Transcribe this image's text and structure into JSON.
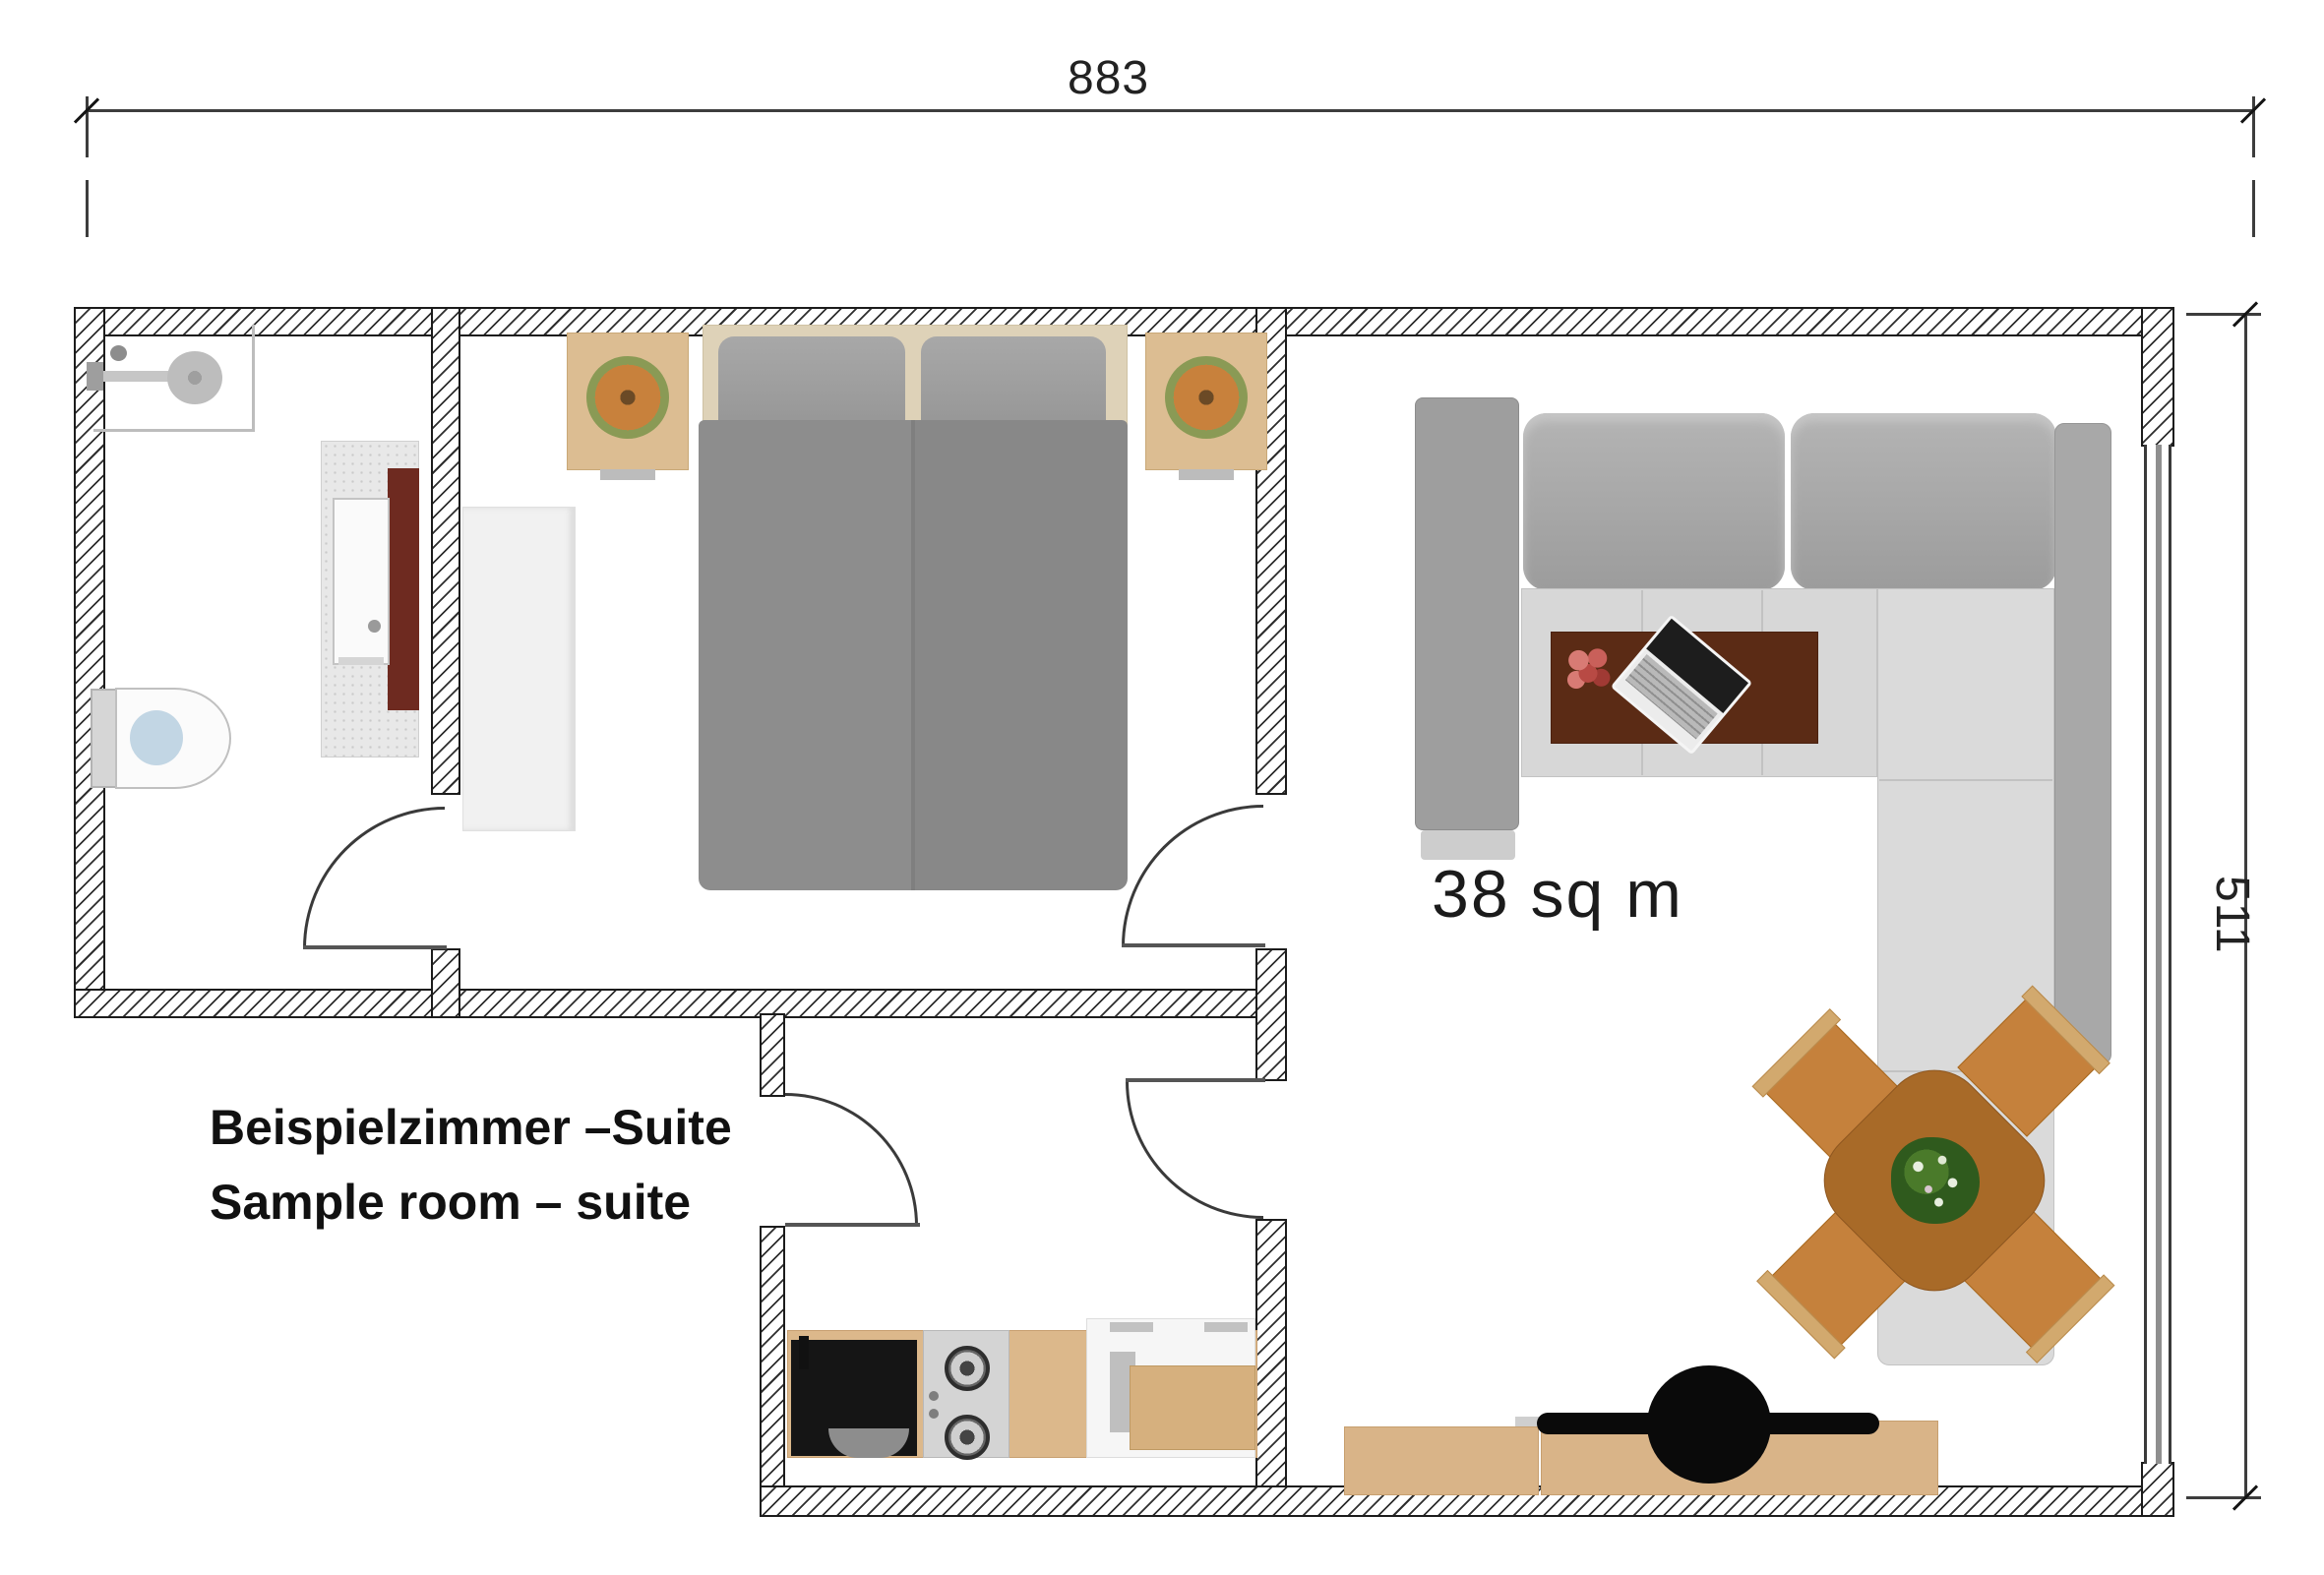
{
  "plan": {
    "type": "floor-plan",
    "title_line1": "Beispielzimmer –Suite",
    "title_line2": "Sample room – suite",
    "area_label": "38 sq m",
    "dimensions": {
      "width": "883",
      "depth": "511"
    },
    "rooms": [
      "bathroom",
      "bedroom",
      "kitchen",
      "living-room"
    ],
    "furniture": {
      "bathroom": [
        "shower",
        "toilet",
        "vanity-with-sink"
      ],
      "bedroom": [
        "double-bed",
        "nightstand-left",
        "nightstand-right",
        "plant-left",
        "plant-right",
        "wardrobe"
      ],
      "kitchen": [
        "sink-unit",
        "cooktop-two-burners",
        "counter",
        "fridge-unit",
        "side-table"
      ],
      "living_room": [
        "l-shaped-sofa",
        "coffee-table",
        "laptop",
        "flowers",
        "dining-table",
        "four-chairs",
        "table-plant",
        "desk",
        "desk-chair"
      ]
    },
    "doors": [
      "bathroom-door",
      "bedroom-door",
      "entrance-door",
      "kitchen-living-door"
    ],
    "window": "right-wall-window"
  },
  "colors": {
    "wall_line": "#1c1c1c",
    "wood_light": "#dcb88b",
    "wood_dining": "#c5813c",
    "table_brown": "#a86a28",
    "coffee_table": "#5b2b15",
    "maroon_panel": "#6e2a20",
    "sofa_back": "#a6a6a6",
    "sofa_seat": "#d7d7d7",
    "bed_duvet": "#888888",
    "plant_green": "#2f5a1d",
    "water_blue": "#c2d6e4",
    "black_fixture": "#0d0d0d"
  }
}
